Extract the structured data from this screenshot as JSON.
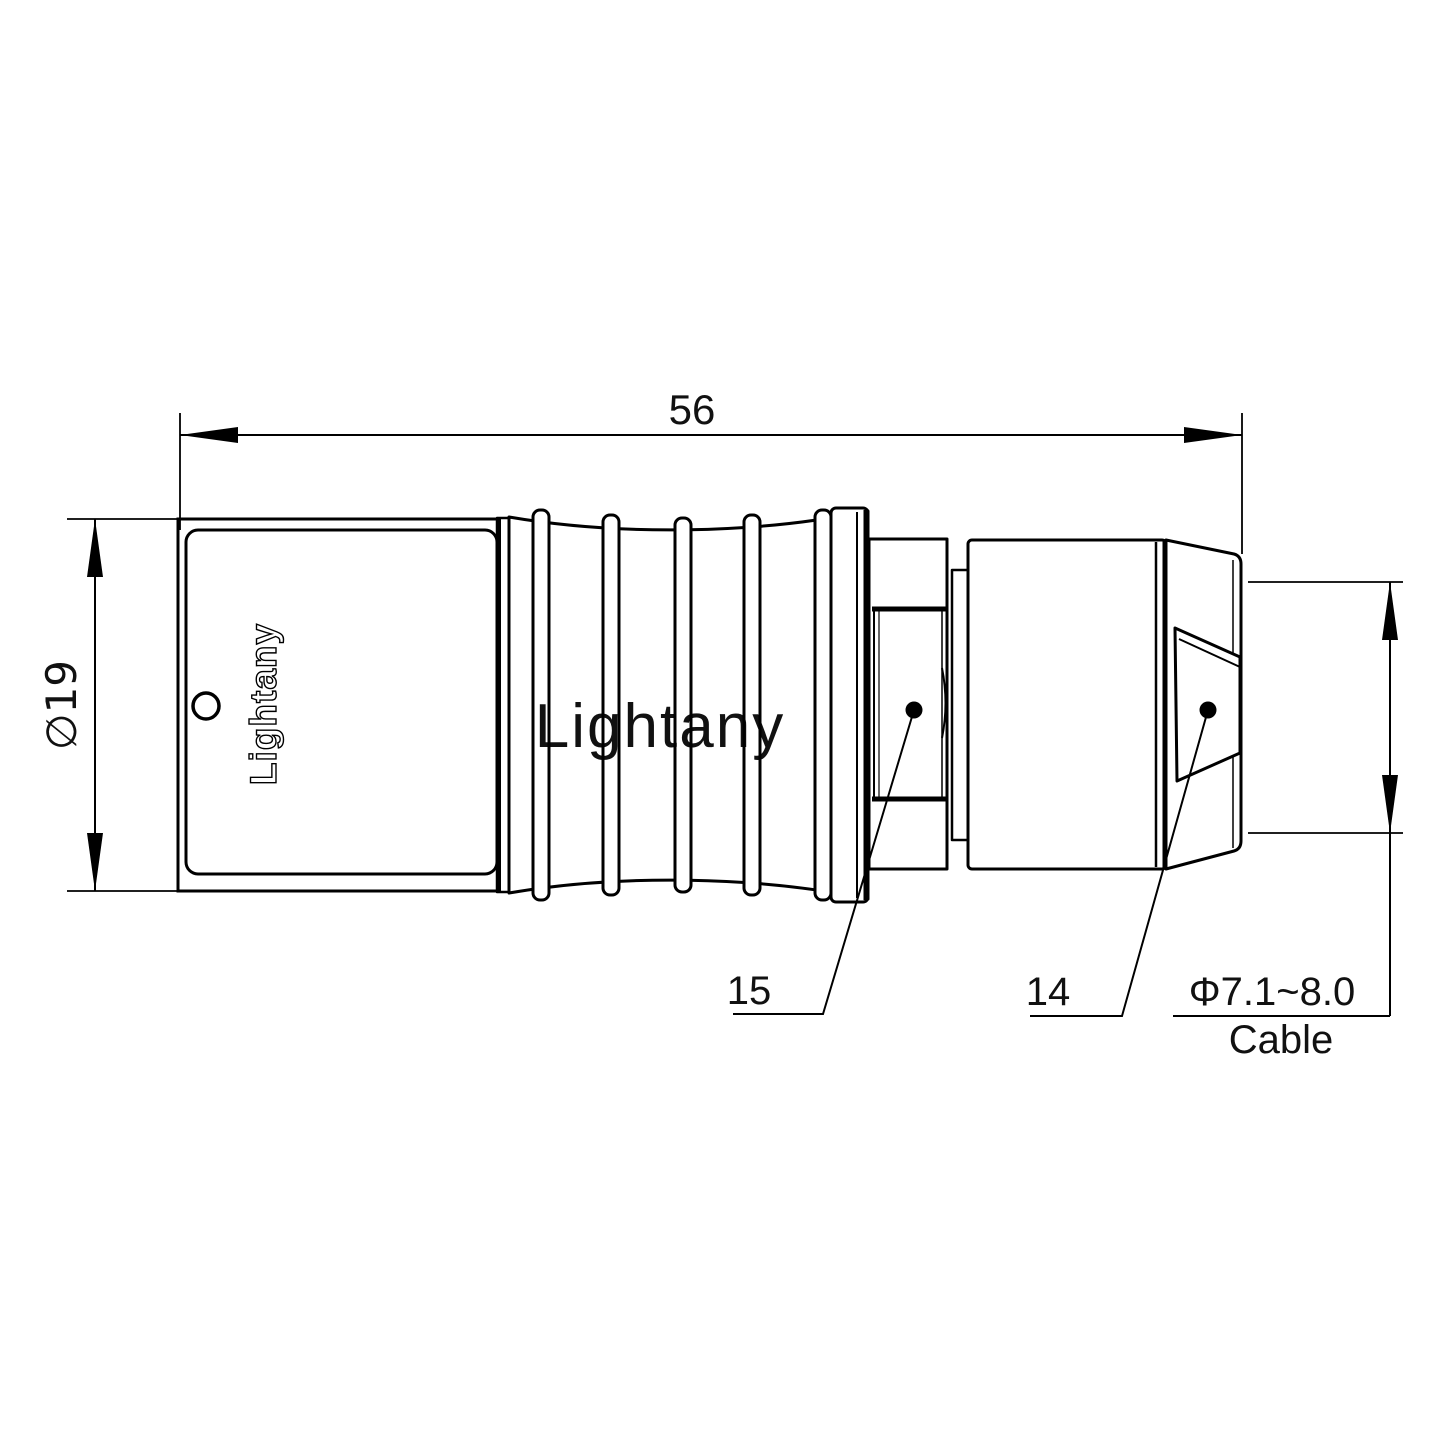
{
  "page": {
    "background": "#ffffff",
    "width": 1440,
    "height": 1440
  },
  "drawing": {
    "kind": "connector-technical-drawing",
    "brand_text": "Lightany",
    "watermark": {
      "text": "Lightany",
      "color": "#f0b6bb"
    },
    "dimensions": {
      "overall_length": {
        "label": "56"
      },
      "body_diameter": {
        "label": "∅19"
      },
      "cable_diameter": {
        "label": "Φ7.1~8.0",
        "caption": "Cable"
      }
    },
    "part_labels": {
      "nut": "15",
      "backshell": "14"
    },
    "colors": {
      "line": "#000000"
    }
  }
}
